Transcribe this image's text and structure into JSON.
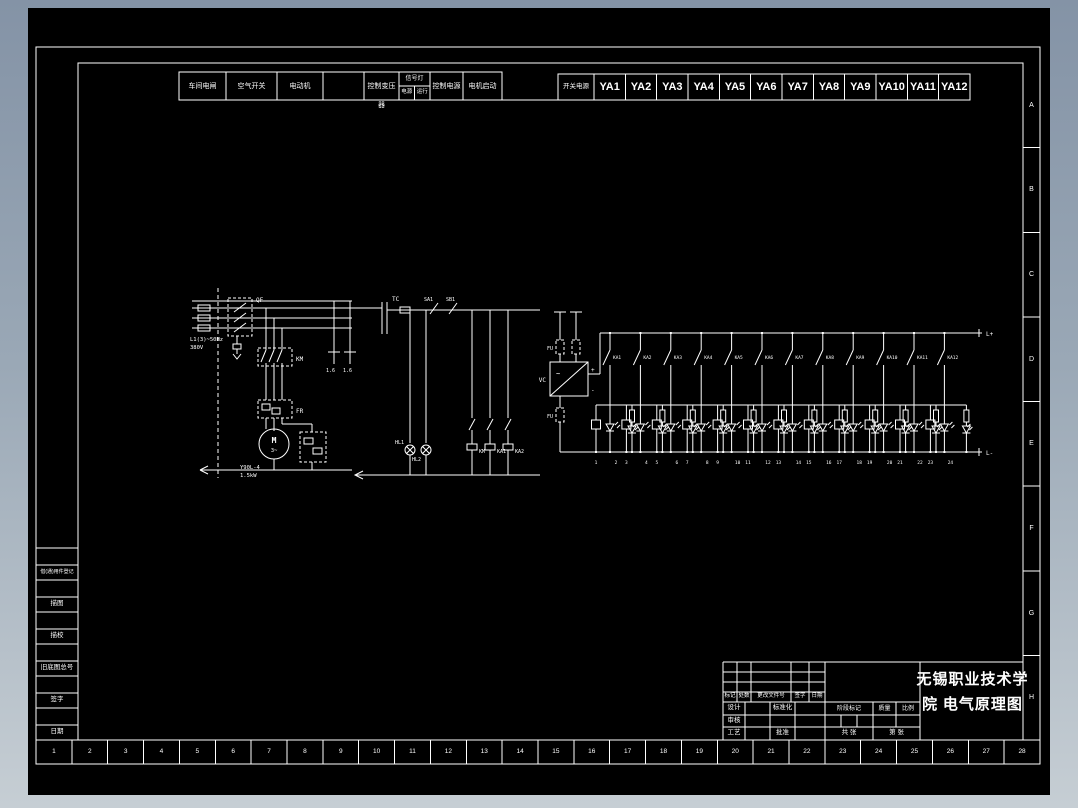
{
  "colors": {
    "line": "#ffffff",
    "background": "#000000",
    "desktop_top": "#8493a6",
    "desktop_bottom": "#c6ced4"
  },
  "header": {
    "cells": [
      {
        "label": "车间电闸"
      },
      {
        "label": "空气开关"
      },
      {
        "label": "电动机"
      },
      {
        "label": ""
      },
      {
        "label": "控制变压",
        "wrap": "器"
      },
      {
        "label": "信号灯",
        "sub": [
          "电源",
          "运行"
        ]
      },
      {
        "label": "控制电源"
      },
      {
        "label": "电机启动"
      }
    ],
    "power_label": "开关电源",
    "valves": [
      "YA1",
      "YA2",
      "YA3",
      "YA4",
      "YA5",
      "YA6",
      "YA7",
      "YA8",
      "YA9",
      "YA10",
      "YA11",
      "YA12"
    ]
  },
  "zones": {
    "letters": [
      "A",
      "B",
      "C",
      "D",
      "E",
      "F",
      "G",
      "H"
    ],
    "numbers": [
      "1",
      "2",
      "3",
      "4",
      "5",
      "6",
      "7",
      "8",
      "9",
      "10",
      "11",
      "12",
      "13",
      "14",
      "15",
      "16",
      "17",
      "18",
      "19",
      "20",
      "21",
      "22",
      "23",
      "24",
      "25",
      "26",
      "27",
      "28"
    ]
  },
  "side_panel": {
    "labels": [
      "借(通)用件登记",
      "描图",
      "描校",
      "旧底图总号",
      "签字",
      "日期"
    ]
  },
  "title_block": {
    "school_line1": "无锡职业技术学",
    "school_line2": "院 电气原理图",
    "rev_header": [
      "标记",
      "处数",
      "更改文件号",
      "签字",
      "日期"
    ],
    "role_rows": [
      [
        "设计",
        "标准化"
      ],
      [
        "审核",
        ""
      ],
      [
        "工艺",
        "批准"
      ]
    ],
    "stage_header": [
      "阶段标记",
      "质量",
      "比例"
    ],
    "sheet_left": "共 张",
    "sheet_right": "第 张"
  },
  "schematic": {
    "supply_line1": "L1(3)~50Hz",
    "supply_line2": "380V",
    "breaker": "QF",
    "contactor": "KM",
    "thermal": "FR",
    "motor_letter": "M",
    "motor_phase": "3~",
    "motor_model": "Y90L-4",
    "motor_power": "1.5kW",
    "transformer": "TC",
    "fuse_label": "FU",
    "fuse_rating_1": "1.6",
    "fuse_rating_2": "1.6",
    "switch_1": "SA1",
    "switch_2": "SB1",
    "lamp_1": "HL1",
    "lamp_2": "HL2",
    "coil_1": "KM",
    "coil_2": "KA1",
    "coil_3": "KA2",
    "psu_label": "VC",
    "psu_ac": "~",
    "psu_plus": "+",
    "psu_minus": "-",
    "bus_plus": "L+",
    "bus_minus": "L-",
    "branches": [
      {
        "contact": "KA1",
        "w1": "1",
        "w2": "2"
      },
      {
        "contact": "KA2",
        "w1": "3",
        "w2": "4"
      },
      {
        "contact": "KA3",
        "w1": "5",
        "w2": "6"
      },
      {
        "contact": "KA4",
        "w1": "7",
        "w2": "8"
      },
      {
        "contact": "KA5",
        "w1": "9",
        "w2": "10"
      },
      {
        "contact": "KA6",
        "w1": "11",
        "w2": "12"
      },
      {
        "contact": "KA7",
        "w1": "13",
        "w2": "14"
      },
      {
        "contact": "KA8",
        "w1": "15",
        "w2": "16"
      },
      {
        "contact": "KA9",
        "w1": "17",
        "w2": "18"
      },
      {
        "contact": "KA10",
        "w1": "19",
        "w2": "20"
      },
      {
        "contact": "KA11",
        "w1": "21",
        "w2": "22"
      },
      {
        "contact": "KA12",
        "w1": "23",
        "w2": "24"
      }
    ]
  }
}
